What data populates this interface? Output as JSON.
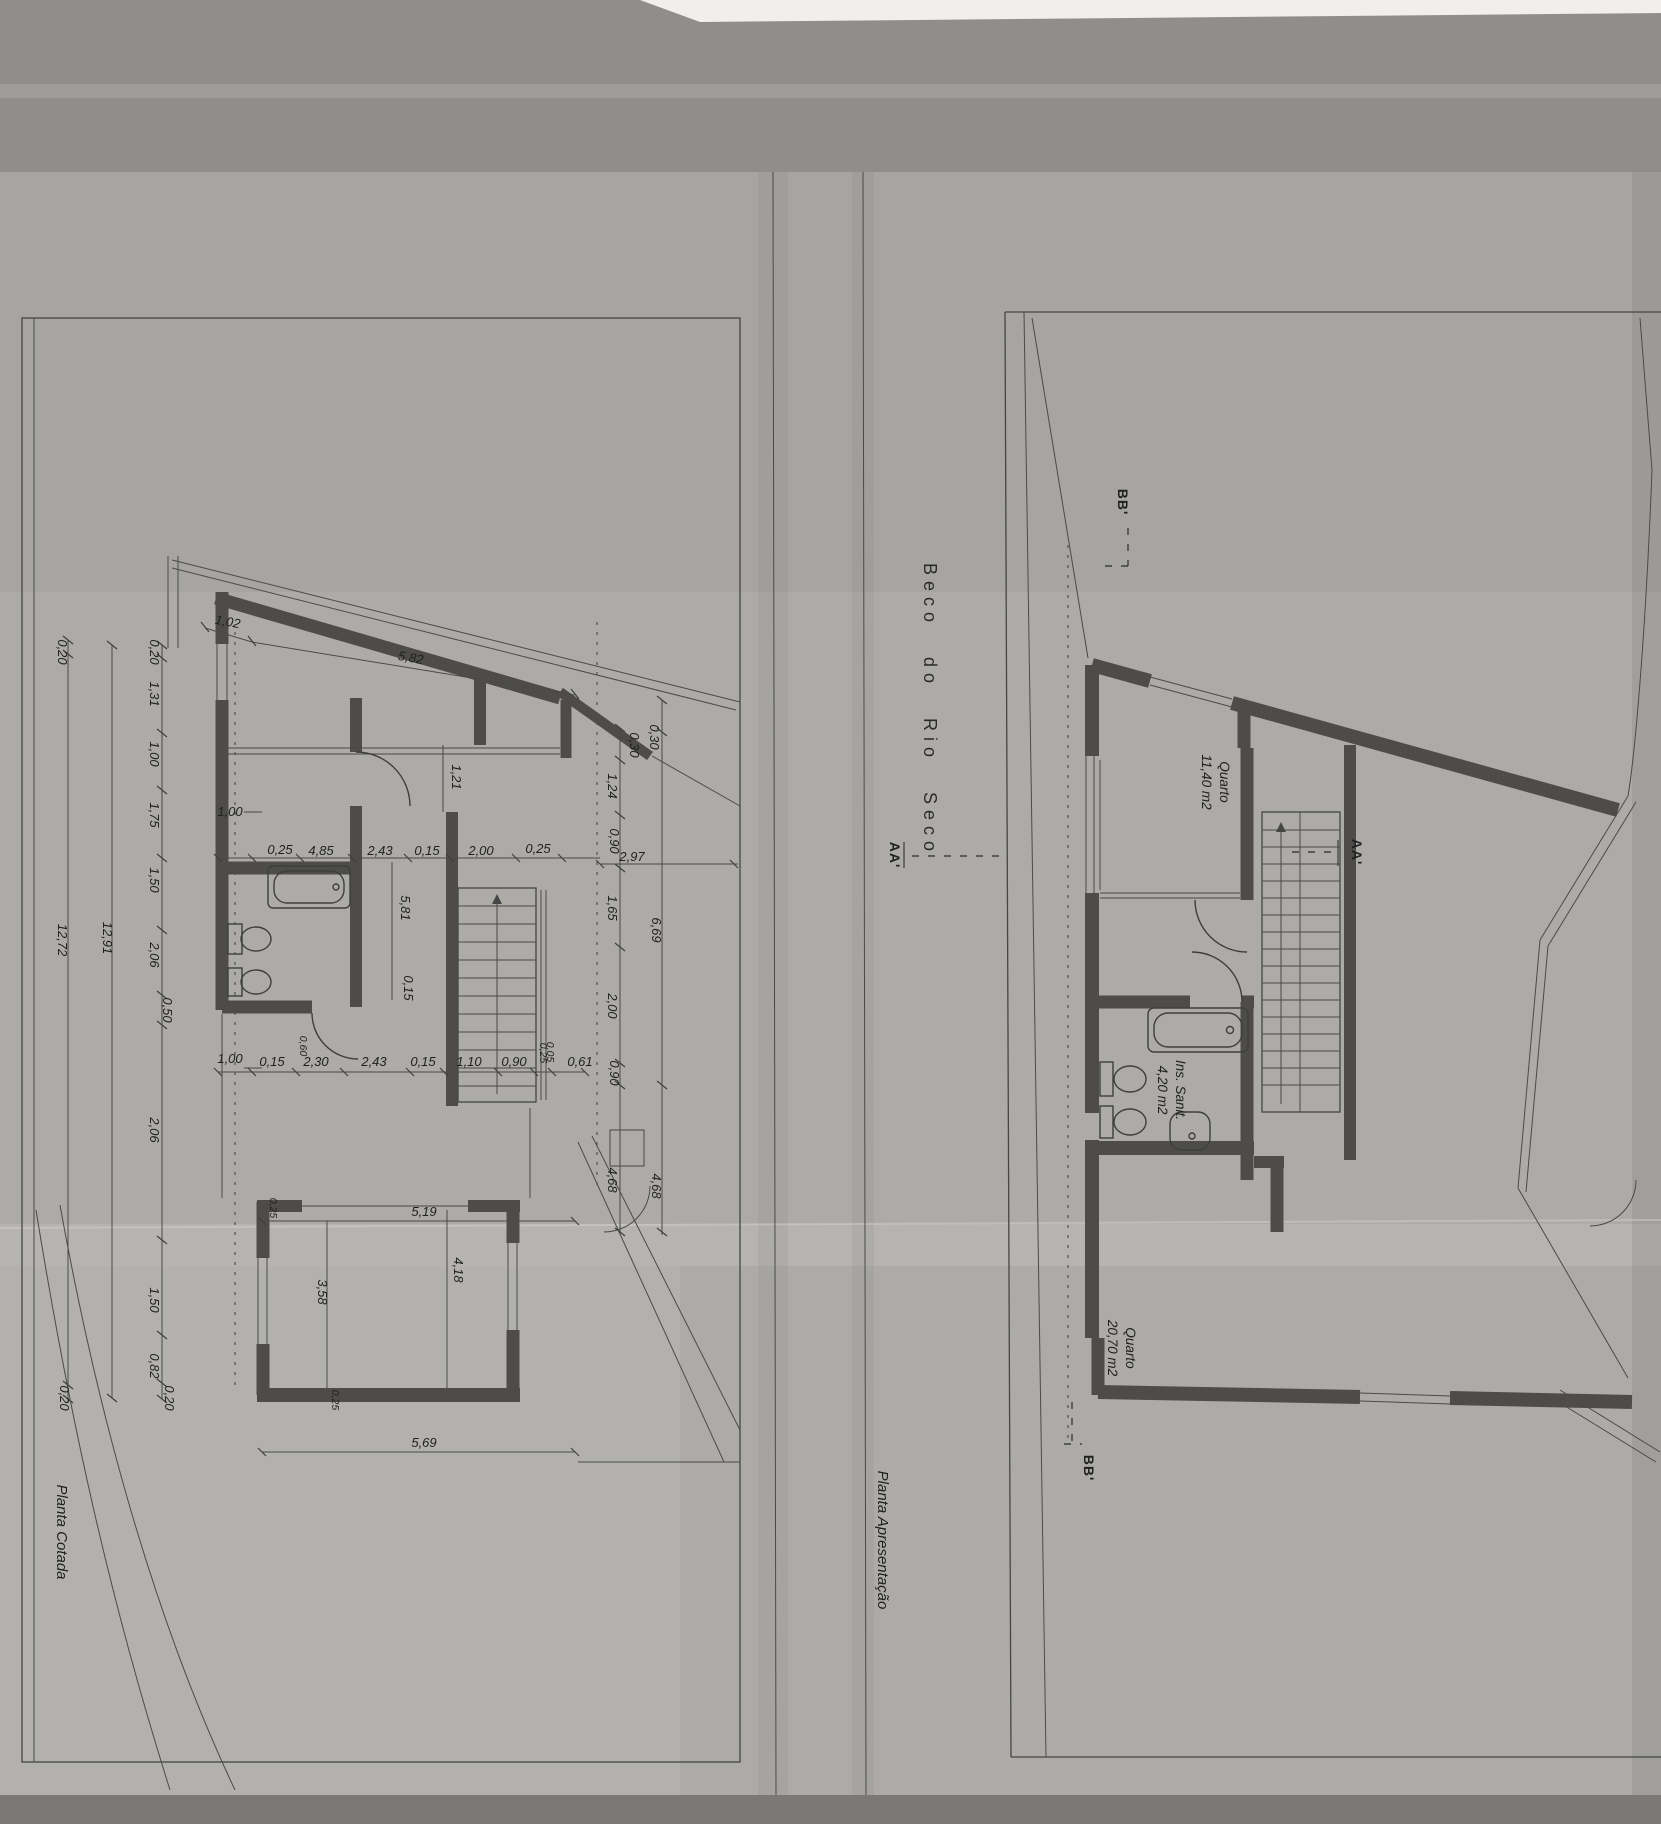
{
  "title": {
    "text": "Beco do Rio Seco"
  },
  "captions": {
    "left": "Planta Cotada",
    "right": "Planta Apresentação"
  },
  "sections": {
    "bb": "BB'",
    "aa": "AA'"
  },
  "rooms": [
    {
      "name": "Quarto",
      "area": "11,40 m2"
    },
    {
      "name": "Ins. Sanit.",
      "area": "4,20 m2"
    },
    {
      "name": "Quarto",
      "area": "20,70 m2"
    }
  ],
  "dims": {
    "top": [
      "1,02",
      "5,82"
    ],
    "chain_outer": [
      "0,20",
      "12,72",
      "0,20"
    ],
    "chain_total": "12,91",
    "chain_left": [
      "0,20",
      "1,31",
      "1,00",
      "1,75",
      "1,50",
      "2,06",
      "0,50",
      "2,06",
      "1,50",
      "0,82",
      "0,20"
    ],
    "row_upper": [
      "1,00",
      "0,25",
      "4,85",
      "2,43",
      "0,15",
      "2,00",
      "0,25",
      "2,97"
    ],
    "row_lower": [
      "1,00",
      "0,15",
      "2,30",
      "2,43",
      "0,15",
      "1,10",
      "0,90",
      "0,05",
      "0,61"
    ],
    "col_right": [
      "0,30",
      "1,24",
      "0,90",
      "1,65",
      "2,00",
      "0,90",
      "4,68"
    ],
    "col_right_outer": [
      "0,30",
      "6,69",
      "4,68"
    ],
    "inner": [
      "1,21",
      "5,81",
      "0,15",
      "0,60"
    ],
    "small": [
      "0,25",
      "0,25",
      "0,25"
    ],
    "bottom": [
      "5,19",
      "3,58",
      "4,18",
      "5,69"
    ]
  }
}
